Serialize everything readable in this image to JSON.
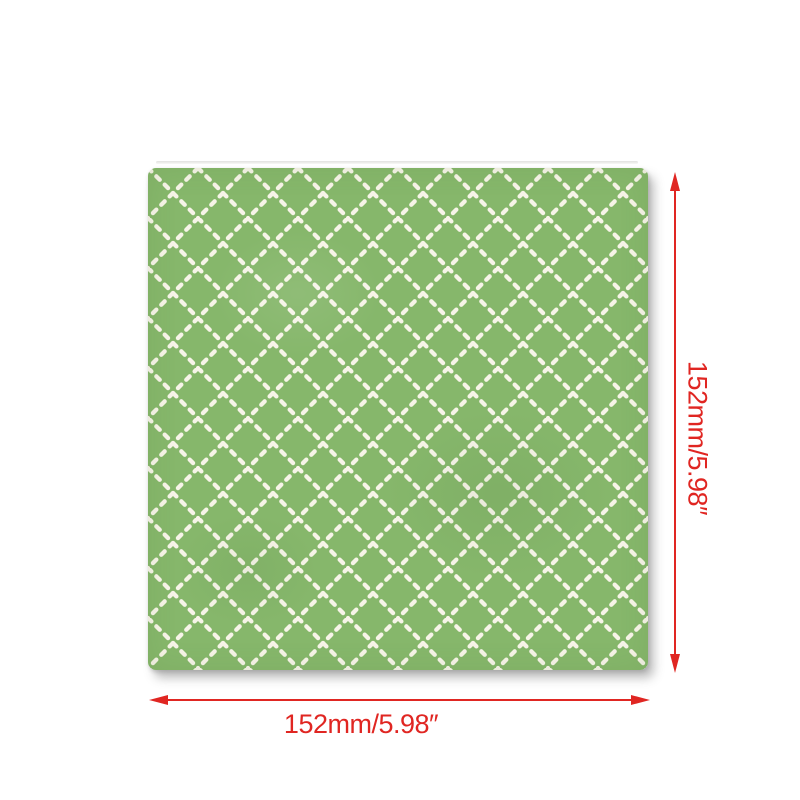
{
  "canvas": {
    "background": "#ffffff"
  },
  "product": {
    "name": "green diamond lattice fabric swatch",
    "pattern": "diagonal beaded lattice",
    "fabric_green": "#86b76b",
    "lattice_white": "#f7f4e8"
  },
  "dimensions": {
    "width_label": "152mm/5.98″",
    "height_label": "152mm/5.98″",
    "arrow_color": "#e02622"
  }
}
